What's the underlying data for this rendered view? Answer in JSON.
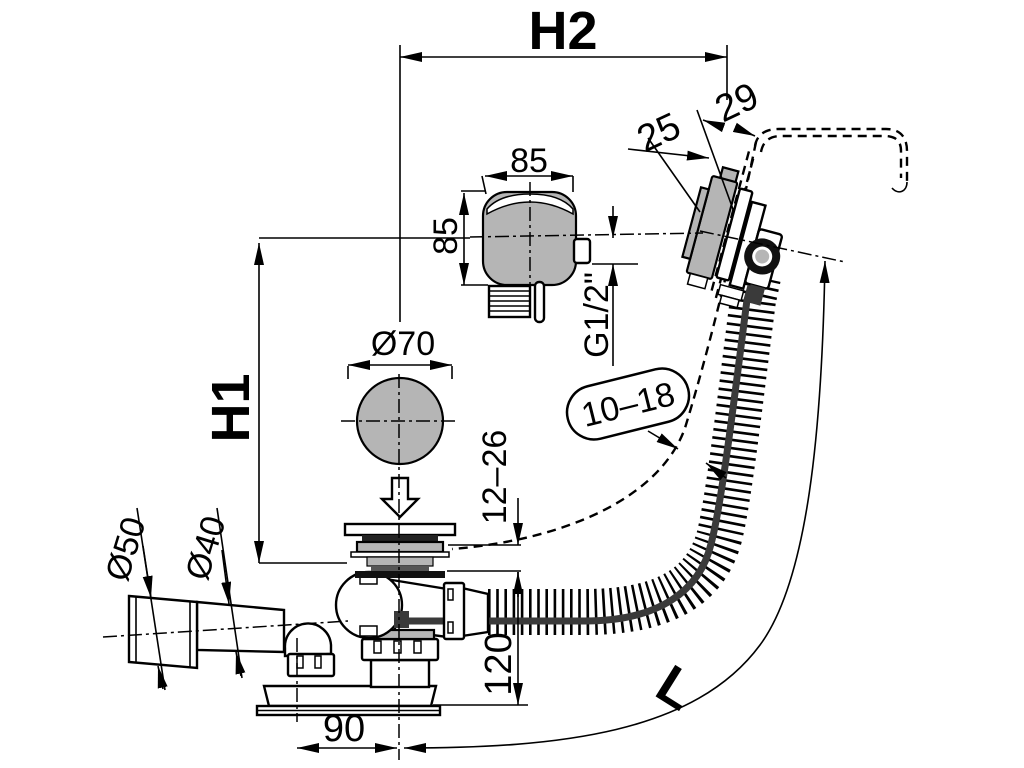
{
  "labels": {
    "h2": "H2",
    "h1": "H1",
    "length": "L",
    "head_width": "85",
    "head_height": "85",
    "overflow_front": "25",
    "overflow_depth": "29",
    "thread": "G1/2\"",
    "knob_diameter": "Ø70",
    "wall_gap": "10–18",
    "plug_range": "12–26",
    "outlet_sleeve_diameter": "Ø50",
    "outlet_pipe_diameter": "Ø40",
    "waste_height": "120",
    "outlet_offset": "90"
  },
  "colors": {
    "line": "#000000",
    "metal_gray": "#b5b5b5",
    "cable_dark": "#3a3a3a",
    "background": "#ffffff"
  }
}
